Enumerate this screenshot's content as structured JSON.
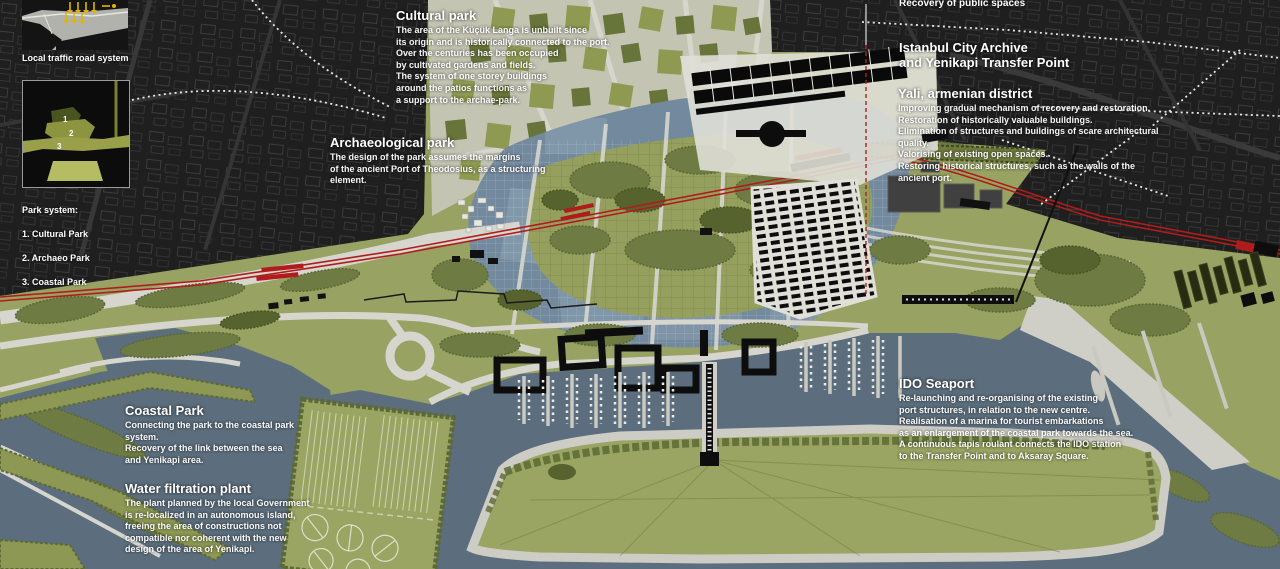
{
  "insets": {
    "traffic": {
      "caption": "Local traffic road system"
    },
    "park_system": {
      "caption_title": "Park system:",
      "items": [
        "1. Cultural Park",
        "2. Archaeo Park",
        "3. Coastal Park"
      ],
      "labels": [
        "1",
        "2",
        "3"
      ]
    }
  },
  "annotations": {
    "recovery": {
      "title": "Recovery of public spaces"
    },
    "cultural_park": {
      "title": "Cultural park",
      "body": "The area of the Küçük Langa is unbuilt since\nits origin and is historically connected to the port.\nOver the centuries has been occupied\nby cultivated gardens and fields.\nThe system of one storey buildings\naround the patios functions as\na support to the archae-park."
    },
    "archaeological_park": {
      "title": "Archaeological park",
      "body": "The design of the park assumes the margins\nof the ancient Port of Theodosius, as a structuring\nelement."
    },
    "archive": {
      "title": "Istanbul City Archive\nand Yenikapi Transfer Point"
    },
    "yali": {
      "title": "Yali, armenian district",
      "body": "Improving gradual mechanism of recovery and restoration.\nRestoration of historically valuable buildings.\nElimination of structures and buildings of scare architectural quality.\nValorising of existing open spaces.\nRestoring historical structures, such as the walls of the ancient port."
    },
    "ido": {
      "title": "IDO Seaport",
      "body": "Re-launching and re-organising of the existing\nport structures, in relation to the new centre.\nRealisation of a marina for tourist embarkations\nas an enlargement of the coastal park towards the sea.\nA continuous tapis roulant connects the IDO station\nto the Transfer Point and to Aksaray Square."
    },
    "coastal_park": {
      "title": "Coastal Park",
      "body": "Connecting the park to the coastal park system.\nRecovery of the link between the sea\nand Yenikapi area."
    },
    "water_filtration": {
      "title": "Water filtration plant",
      "body": "The plant planned by the local Government\nis re-localized in an autonomous island,\nfreeing the area of constructions not\ncompatible nor coherent with the new\ndesign of the area of Yenikapi."
    }
  },
  "map_features": [
    "city-fabric",
    "railway-line",
    "railway-stations",
    "archaeological-basin",
    "archae-park-meadow",
    "cultivated-gardens",
    "yali-district-blocks",
    "transfer-point-buildings",
    "city-archive-buildings",
    "ancient-walls-line",
    "pedestrian-routes-dotted",
    "roundabout",
    "waterfront-buildings",
    "marina-piers",
    "tapis-roulant-pier",
    "coastal-park-island",
    "water-filtration-island",
    "ido-terminal-quay",
    "sea"
  ],
  "colors": {
    "background_city": "#1d1d1d",
    "park_green": "#98a262",
    "tree_green": "#6e7b43",
    "dark_tree_green": "#56632e",
    "road_grey": "#d6d6cf",
    "sea_blue": "#5c6e7d",
    "basin_blue": "#73899d",
    "railway_red": "#b01c1c",
    "building_black": "#0d0d0d",
    "plaza_white": "#e0e0d8",
    "arrow_yellow": "#e0b400",
    "text_white": "#ffffff"
  }
}
